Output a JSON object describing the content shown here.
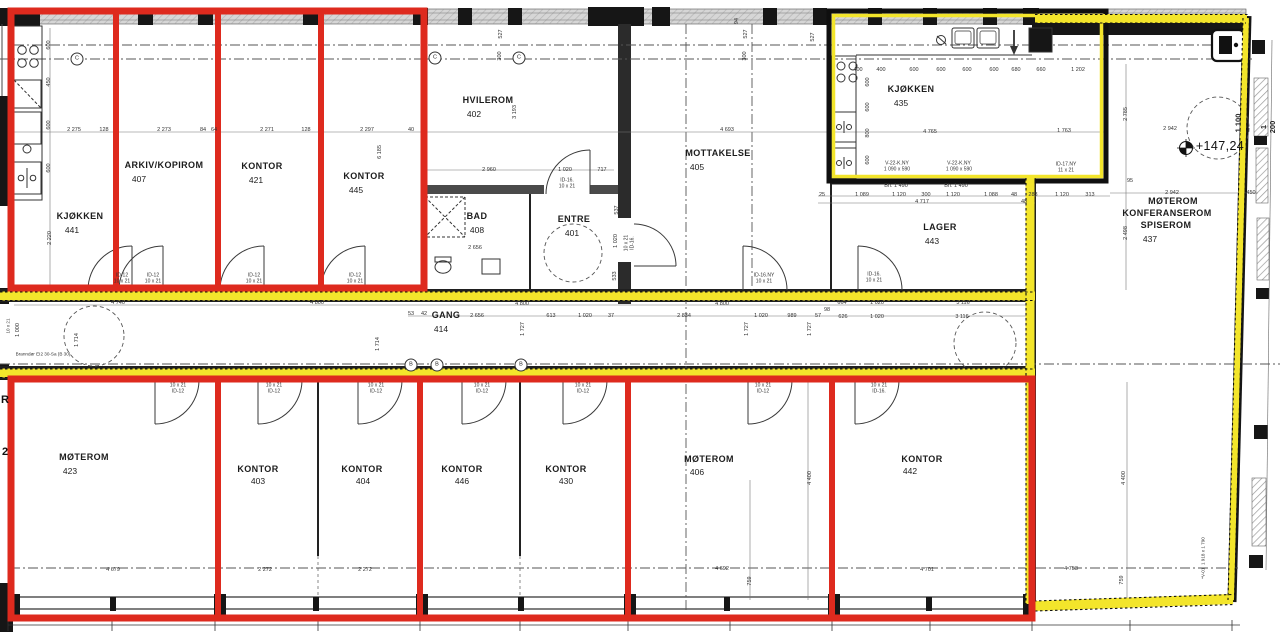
{
  "plan": {
    "colors": {
      "highlight_red": "#de2a1e",
      "highlight_yellow": "#f3e52b",
      "wall_black": "#161616",
      "window_grey": "#cfcfcf"
    },
    "rooms": [
      {
        "name": "KJØKKEN",
        "number": "441"
      },
      {
        "name": "ARKIV/KOPIROM",
        "number": "407"
      },
      {
        "name": "KONTOR",
        "number": "421"
      },
      {
        "name": "KONTOR",
        "number": "445"
      },
      {
        "name": "HVILEROM",
        "number": "402"
      },
      {
        "name": "BAD",
        "number": "408"
      },
      {
        "name": "ENTRE",
        "number": "401"
      },
      {
        "name": "MOTTAKELSE",
        "number": "405"
      },
      {
        "name": "KJØKKEN",
        "number": "435"
      },
      {
        "name": "LAGER",
        "number": "443"
      },
      {
        "name": "MØTEROM KONFERANSEROM SPISEROM",
        "number": "437"
      },
      {
        "name": "GANG",
        "number": "414"
      },
      {
        "name": "MØTEROM",
        "number": "423"
      },
      {
        "name": "KONTOR",
        "number": "403"
      },
      {
        "name": "KONTOR",
        "number": "404"
      },
      {
        "name": "KONTOR",
        "number": "446"
      },
      {
        "name": "KONTOR",
        "number": "430"
      },
      {
        "name": "MØTEROM",
        "number": "406"
      },
      {
        "name": "KONTOR",
        "number": "442"
      }
    ],
    "labels": [
      {
        "t": "KJØKKEN",
        "x": 80,
        "y": 216,
        "c": "room"
      },
      {
        "t": "441",
        "x": 72,
        "y": 230,
        "c": "roomnum"
      },
      {
        "t": "ARKIV/KOPIROM",
        "x": 164,
        "y": 165,
        "c": "room"
      },
      {
        "t": "407",
        "x": 139,
        "y": 179,
        "c": "roomnum"
      },
      {
        "t": "KONTOR",
        "x": 262,
        "y": 166,
        "c": "room"
      },
      {
        "t": "421",
        "x": 256,
        "y": 180,
        "c": "roomnum"
      },
      {
        "t": "KONTOR",
        "x": 364,
        "y": 176,
        "c": "room"
      },
      {
        "t": "445",
        "x": 356,
        "y": 190,
        "c": "roomnum"
      },
      {
        "t": "HVILEROM",
        "x": 488,
        "y": 100,
        "c": "room"
      },
      {
        "t": "402",
        "x": 474,
        "y": 114,
        "c": "roomnum"
      },
      {
        "t": "BAD",
        "x": 477,
        "y": 216,
        "c": "room"
      },
      {
        "t": "408",
        "x": 477,
        "y": 230,
        "c": "roomnum"
      },
      {
        "t": "ENTRE",
        "x": 574,
        "y": 219,
        "c": "room"
      },
      {
        "t": "401",
        "x": 572,
        "y": 233,
        "c": "roomnum"
      },
      {
        "t": "MOTTAKELSE",
        "x": 718,
        "y": 153,
        "c": "room"
      },
      {
        "t": "405",
        "x": 697,
        "y": 167,
        "c": "roomnum"
      },
      {
        "t": "KJØKKEN",
        "x": 911,
        "y": 89,
        "c": "room"
      },
      {
        "t": "435",
        "x": 901,
        "y": 103,
        "c": "roomnum"
      },
      {
        "t": "LAGER",
        "x": 940,
        "y": 227,
        "c": "room"
      },
      {
        "t": "443",
        "x": 932,
        "y": 241,
        "c": "roomnum"
      },
      {
        "t": "MØTEROM",
        "x": 1173,
        "y": 201,
        "c": "room"
      },
      {
        "t": "KONFERANSEROM",
        "x": 1167,
        "y": 213,
        "c": "room"
      },
      {
        "t": "SPISEROM",
        "x": 1166,
        "y": 225,
        "c": "room"
      },
      {
        "t": "437",
        "x": 1150,
        "y": 239,
        "c": "roomnum"
      },
      {
        "t": "GANG",
        "x": 446,
        "y": 315,
        "c": "room"
      },
      {
        "t": "414",
        "x": 441,
        "y": 329,
        "c": "roomnum"
      },
      {
        "t": "MØTEROM",
        "x": 84,
        "y": 457,
        "c": "room"
      },
      {
        "t": "423",
        "x": 70,
        "y": 471,
        "c": "roomnum"
      },
      {
        "t": "KONTOR",
        "x": 258,
        "y": 469,
        "c": "room"
      },
      {
        "t": "403",
        "x": 258,
        "y": 481,
        "c": "roomnum"
      },
      {
        "t": "KONTOR",
        "x": 362,
        "y": 469,
        "c": "room"
      },
      {
        "t": "404",
        "x": 363,
        "y": 481,
        "c": "roomnum"
      },
      {
        "t": "KONTOR",
        "x": 462,
        "y": 469,
        "c": "room"
      },
      {
        "t": "446",
        "x": 462,
        "y": 481,
        "c": "roomnum"
      },
      {
        "t": "KONTOR",
        "x": 566,
        "y": 469,
        "c": "room"
      },
      {
        "t": "430",
        "x": 566,
        "y": 481,
        "c": "roomnum"
      },
      {
        "t": "MØTEROM",
        "x": 709,
        "y": 459,
        "c": "room"
      },
      {
        "t": "406",
        "x": 697,
        "y": 472,
        "c": "roomnum"
      },
      {
        "t": "KONTOR",
        "x": 922,
        "y": 459,
        "c": "room"
      },
      {
        "t": "442",
        "x": 910,
        "y": 471,
        "c": "roomnum"
      },
      {
        "t": "ID-12\n10 x 21",
        "x": 122,
        "y": 279,
        "c": "door"
      },
      {
        "t": "ID-12\n10 x 21",
        "x": 153,
        "y": 279,
        "c": "door"
      },
      {
        "t": "ID-12\n10 x 21",
        "x": 254,
        "y": 279,
        "c": "door"
      },
      {
        "t": "ID-12\n10 x 21",
        "x": 355,
        "y": 279,
        "c": "door"
      },
      {
        "t": "ID-16.\n10 x 21",
        "x": 567,
        "y": 184,
        "c": "door"
      },
      {
        "t": "10 x 21\nID-16.",
        "x": 630,
        "y": 243,
        "c": "door",
        "r": 1
      },
      {
        "t": "ID-16.NY\n10 x 21",
        "x": 764,
        "y": 279,
        "c": "door"
      },
      {
        "t": "ID-16.\n10 x 21",
        "x": 874,
        "y": 278,
        "c": "door"
      },
      {
        "t": "ID-17.NY\n11 x 21",
        "x": 1066,
        "y": 168,
        "c": "door"
      },
      {
        "t": "10 x 21\nID-12",
        "x": 178,
        "y": 389,
        "c": "door"
      },
      {
        "t": "10 x 21\nID-12",
        "x": 274,
        "y": 389,
        "c": "door"
      },
      {
        "t": "10 x 21\nID-12",
        "x": 376,
        "y": 389,
        "c": "door"
      },
      {
        "t": "10 x 21\nID-12",
        "x": 482,
        "y": 389,
        "c": "door"
      },
      {
        "t": "10 x 21\nID-12",
        "x": 583,
        "y": 389,
        "c": "door"
      },
      {
        "t": "10 x 21\nID-12",
        "x": 763,
        "y": 389,
        "c": "door"
      },
      {
        "t": "10 x 21\nID-16.",
        "x": 879,
        "y": 389,
        "c": "door"
      },
      {
        "t": "V-22-K.NY\n1 090 x 590",
        "x": 897,
        "y": 167,
        "c": "door"
      },
      {
        "t": "V-22-K.NY\n1 090 x 590",
        "x": 959,
        "y": 167,
        "c": "door"
      },
      {
        "t": "2 275",
        "x": 74,
        "y": 130,
        "c": "dim"
      },
      {
        "t": "128",
        "x": 104,
        "y": 130,
        "c": "dim"
      },
      {
        "t": "2 273",
        "x": 164,
        "y": 130,
        "c": "dim"
      },
      {
        "t": "84",
        "x": 203,
        "y": 130,
        "c": "dim"
      },
      {
        "t": "64",
        "x": 214,
        "y": 130,
        "c": "dim"
      },
      {
        "t": "2 271",
        "x": 267,
        "y": 130,
        "c": "dim"
      },
      {
        "t": "128",
        "x": 306,
        "y": 130,
        "c": "dim"
      },
      {
        "t": "2 297",
        "x": 367,
        "y": 130,
        "c": "dim"
      },
      {
        "t": "40",
        "x": 411,
        "y": 130,
        "c": "dim"
      },
      {
        "t": "2 960",
        "x": 489,
        "y": 170,
        "c": "dim"
      },
      {
        "t": "1 020",
        "x": 565,
        "y": 170,
        "c": "dim"
      },
      {
        "t": "717",
        "x": 602,
        "y": 170,
        "c": "dim"
      },
      {
        "t": "4 693",
        "x": 727,
        "y": 130,
        "c": "dim"
      },
      {
        "t": "4 765",
        "x": 930,
        "y": 132,
        "c": "dim"
      },
      {
        "t": "1 763",
        "x": 1064,
        "y": 131,
        "c": "dim"
      },
      {
        "t": "2 942",
        "x": 1170,
        "y": 129,
        "c": "dim"
      },
      {
        "t": "2 942",
        "x": 1172,
        "y": 193,
        "c": "dim"
      },
      {
        "t": "450",
        "x": 1251,
        "y": 193,
        "c": "dim"
      },
      {
        "t": "95",
        "x": 1130,
        "y": 181,
        "c": "dim"
      },
      {
        "t": "+147,24",
        "x": 1220,
        "y": 146,
        "c": "elev"
      },
      {
        "t": "4 740",
        "x": 118,
        "y": 303,
        "c": "dim"
      },
      {
        "t": "4 800",
        "x": 317,
        "y": 303,
        "c": "dim"
      },
      {
        "t": "4 800",
        "x": 522,
        "y": 304,
        "c": "dim"
      },
      {
        "t": "4 800",
        "x": 722,
        "y": 304,
        "c": "dim"
      },
      {
        "t": "53",
        "x": 411,
        "y": 314,
        "c": "dim"
      },
      {
        "t": "42",
        "x": 424,
        "y": 314,
        "c": "dim"
      },
      {
        "t": "2 656",
        "x": 477,
        "y": 316,
        "c": "dim"
      },
      {
        "t": "613",
        "x": 551,
        "y": 316,
        "c": "dim"
      },
      {
        "t": "1 020",
        "x": 585,
        "y": 316,
        "c": "dim"
      },
      {
        "t": "37",
        "x": 611,
        "y": 316,
        "c": "dim"
      },
      {
        "t": "2 834",
        "x": 684,
        "y": 316,
        "c": "dim"
      },
      {
        "t": "1 020",
        "x": 761,
        "y": 316,
        "c": "dim"
      },
      {
        "t": "989",
        "x": 792,
        "y": 316,
        "c": "dim"
      },
      {
        "t": "57",
        "x": 818,
        "y": 316,
        "c": "dim"
      },
      {
        "t": "664",
        "x": 842,
        "y": 303,
        "c": "dim"
      },
      {
        "t": "1 020",
        "x": 877,
        "y": 303,
        "c": "dim"
      },
      {
        "t": "3 116",
        "x": 963,
        "y": 303,
        "c": "dim"
      },
      {
        "t": "98",
        "x": 827,
        "y": 310,
        "c": "dim"
      },
      {
        "t": "626",
        "x": 843,
        "y": 317,
        "c": "dim"
      },
      {
        "t": "1 020",
        "x": 877,
        "y": 317,
        "c": "dim"
      },
      {
        "t": "3 116",
        "x": 962,
        "y": 317,
        "c": "dim"
      },
      {
        "t": "4 717",
        "x": 922,
        "y": 202,
        "c": "dim"
      },
      {
        "t": "48",
        "x": 1024,
        "y": 202,
        "c": "dim"
      },
      {
        "t": "25",
        "x": 822,
        "y": 195,
        "c": "dim"
      },
      {
        "t": "1 089",
        "x": 862,
        "y": 195,
        "c": "dim"
      },
      {
        "t": "1 120",
        "x": 899,
        "y": 195,
        "c": "dim"
      },
      {
        "t": "300",
        "x": 926,
        "y": 195,
        "c": "dim"
      },
      {
        "t": "1 120",
        "x": 953,
        "y": 195,
        "c": "dim"
      },
      {
        "t": "1 088",
        "x": 991,
        "y": 195,
        "c": "dim"
      },
      {
        "t": "48",
        "x": 1014,
        "y": 195,
        "c": "dim"
      },
      {
        "t": "283",
        "x": 1033,
        "y": 195,
        "c": "dim"
      },
      {
        "t": "1 120",
        "x": 1062,
        "y": 195,
        "c": "dim"
      },
      {
        "t": "313",
        "x": 1090,
        "y": 195,
        "c": "dim"
      },
      {
        "t": "Bh. 1 490",
        "x": 896,
        "y": 186,
        "c": "dim"
      },
      {
        "t": "Bh. 1 490",
        "x": 956,
        "y": 186,
        "c": "dim"
      },
      {
        "t": "400",
        "x": 858,
        "y": 70,
        "c": "dim"
      },
      {
        "t": "400",
        "x": 881,
        "y": 70,
        "c": "dim"
      },
      {
        "t": "600",
        "x": 914,
        "y": 70,
        "c": "dim"
      },
      {
        "t": "600",
        "x": 941,
        "y": 70,
        "c": "dim"
      },
      {
        "t": "600",
        "x": 967,
        "y": 70,
        "c": "dim"
      },
      {
        "t": "600",
        "x": 994,
        "y": 70,
        "c": "dim"
      },
      {
        "t": "680",
        "x": 1016,
        "y": 70,
        "c": "dim"
      },
      {
        "t": "660",
        "x": 1041,
        "y": 70,
        "c": "dim"
      },
      {
        "t": "1 202",
        "x": 1078,
        "y": 70,
        "c": "dim"
      },
      {
        "t": "4 679",
        "x": 113,
        "y": 570,
        "c": "dim"
      },
      {
        "t": "2 272",
        "x": 265,
        "y": 570,
        "c": "dim"
      },
      {
        "t": "2 272",
        "x": 365,
        "y": 570,
        "c": "dim"
      },
      {
        "t": "4 692",
        "x": 722,
        "y": 569,
        "c": "dim"
      },
      {
        "t": "4 701",
        "x": 927,
        "y": 570,
        "c": "dim"
      },
      {
        "t": "4 753",
        "x": 1071,
        "y": 569,
        "c": "dim"
      },
      {
        "t": "2 656",
        "x": 475,
        "y": 248,
        "c": "dim"
      },
      {
        "t": "Branndør EI2 30-Sa (B 30)",
        "x": 43,
        "y": 354,
        "c": "note"
      },
      {
        "t": "2 220",
        "x": 50,
        "y": 238,
        "c": "dim",
        "r": 1
      },
      {
        "t": "600",
        "x": 49,
        "y": 45,
        "c": "dim",
        "r": 1
      },
      {
        "t": "450",
        "x": 49,
        "y": 82,
        "c": "dim",
        "r": 1
      },
      {
        "t": "600",
        "x": 49,
        "y": 125,
        "c": "dim",
        "r": 1
      },
      {
        "t": "600",
        "x": 49,
        "y": 168,
        "c": "dim",
        "r": 1
      },
      {
        "t": "6 185",
        "x": 380,
        "y": 152,
        "c": "dim",
        "r": 1
      },
      {
        "t": "3 193",
        "x": 515,
        "y": 112,
        "c": "dim",
        "r": 1
      },
      {
        "t": "527",
        "x": 501,
        "y": 34,
        "c": "dim",
        "r": 1
      },
      {
        "t": "300",
        "x": 500,
        "y": 56,
        "c": "dim",
        "r": 1
      },
      {
        "t": "527",
        "x": 746,
        "y": 34,
        "c": "dim",
        "r": 1
      },
      {
        "t": "300",
        "x": 745,
        "y": 56,
        "c": "dim",
        "r": 1
      },
      {
        "t": "527",
        "x": 813,
        "y": 37,
        "c": "dim",
        "r": 1
      },
      {
        "t": "94",
        "x": 737,
        "y": 21,
        "c": "dim",
        "r": 1
      },
      {
        "t": "1 714",
        "x": 77,
        "y": 340,
        "c": "dim",
        "r": 1
      },
      {
        "t": "1 714",
        "x": 378,
        "y": 344,
        "c": "dim",
        "r": 1
      },
      {
        "t": "1 727",
        "x": 523,
        "y": 329,
        "c": "dim",
        "r": 1
      },
      {
        "t": "1 727",
        "x": 747,
        "y": 329,
        "c": "dim",
        "r": 1
      },
      {
        "t": "1 727",
        "x": 810,
        "y": 329,
        "c": "dim",
        "r": 1
      },
      {
        "t": "1 100",
        "x": 1238,
        "y": 123,
        "c": "dimbig",
        "r": 1
      },
      {
        "t": "1 200",
        "x": 1268,
        "y": 127,
        "c": "dimbig",
        "r": 1
      },
      {
        "t": "2 785",
        "x": 1126,
        "y": 114,
        "c": "dim",
        "r": 1
      },
      {
        "t": "2 498",
        "x": 1126,
        "y": 233,
        "c": "dim",
        "r": 1
      },
      {
        "t": "4 400",
        "x": 810,
        "y": 478,
        "c": "dim",
        "r": 1
      },
      {
        "t": "759",
        "x": 750,
        "y": 581,
        "c": "dim",
        "r": 1
      },
      {
        "t": "4 400",
        "x": 1124,
        "y": 478,
        "c": "dim",
        "r": 1
      },
      {
        "t": "759",
        "x": 1122,
        "y": 580,
        "c": "dim",
        "r": 1
      },
      {
        "t": "*V-01  1 918 x 1 790",
        "x": 1203,
        "y": 558,
        "c": "note",
        "r": 1
      },
      {
        "t": "1 000",
        "x": 18,
        "y": 330,
        "c": "dim",
        "r": 1
      },
      {
        "t": "10 x 21",
        "x": 8,
        "y": 326,
        "c": "note",
        "r": 1
      },
      {
        "t": "537",
        "x": 617,
        "y": 210,
        "c": "dim",
        "r": 1
      },
      {
        "t": "1 020",
        "x": 616,
        "y": 241,
        "c": "dim",
        "r": 1
      },
      {
        "t": "533",
        "x": 615,
        "y": 276,
        "c": "dim",
        "r": 1
      },
      {
        "t": "600",
        "x": 868,
        "y": 82,
        "c": "dim",
        "r": 1
      },
      {
        "t": "600",
        "x": 868,
        "y": 107,
        "c": "dim",
        "r": 1
      },
      {
        "t": "800",
        "x": 868,
        "y": 133,
        "c": "dim",
        "r": 1
      },
      {
        "t": "600",
        "x": 868,
        "y": 160,
        "c": "dim",
        "r": 1
      },
      {
        "t": "C",
        "x": 77,
        "y": 59,
        "c": "marker"
      },
      {
        "t": "C",
        "x": 435,
        "y": 58,
        "c": "marker"
      },
      {
        "t": "C",
        "x": 519,
        "y": 58,
        "c": "marker"
      },
      {
        "t": "B",
        "x": 411,
        "y": 365,
        "c": "marker"
      },
      {
        "t": "B",
        "x": 437,
        "y": 365,
        "c": "marker"
      },
      {
        "t": "B",
        "x": 521,
        "y": 365,
        "c": "marker"
      },
      {
        "t": "R",
        "x": 5,
        "y": 400,
        "c": "edge"
      },
      {
        "t": "2",
        "x": 5,
        "y": 452,
        "c": "edge"
      }
    ]
  }
}
